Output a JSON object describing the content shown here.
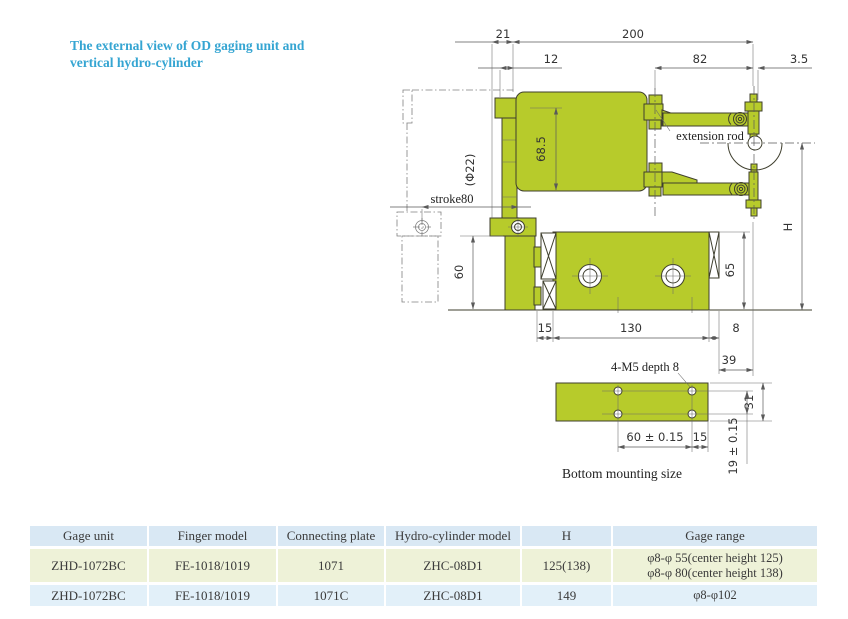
{
  "title": {
    "line1": "The external view of OD gaging unit and",
    "line2": "vertical hydro-cylinder",
    "color": "#35a5d2"
  },
  "drawing": {
    "labels": {
      "dim_21": "21",
      "dim_200": "200",
      "dim_12": "12",
      "dim_82": "82",
      "dim_3_5": "3.5",
      "dim_68_5": "68.5",
      "dim_phi22": "(Φ22)",
      "stroke80": "stroke80",
      "extension_rod": "extension rod",
      "dim_H": "H",
      "dim_60": "60",
      "dim_65": "65",
      "dim_15_front": "15",
      "dim_130": "130",
      "dim_8": "8",
      "dim_39": "39",
      "thread_note": "4-M5 depth 8",
      "dim_60_tol": "60 ± 0.15",
      "dim_15_bottom": "15",
      "dim_31": "31",
      "dim_19_tol": "19 ± 0.15",
      "bottom_caption": "Bottom mounting size"
    },
    "colors": {
      "body_green": "#b7cb2b",
      "outline": "#3f3f2e",
      "dimension_line": "#5a5a5a"
    }
  },
  "table": {
    "headers": [
      "Gage unit",
      "Finger model",
      "Connecting plate",
      "Hydro-cylinder model",
      "H",
      "Gage range"
    ],
    "rows": [
      {
        "cells": [
          "ZHD-1072BC",
          "FE-1018/1019",
          "1071",
          "ZHC-08D1",
          "125(138)"
        ],
        "range_lines": [
          "φ8-φ 55(center height 125)",
          "φ8-φ 80(center height 138)"
        ]
      },
      {
        "cells": [
          "ZHD-1072BC",
          "FE-1018/1019",
          "1071C",
          "ZHC-08D1",
          "149"
        ],
        "range_lines": [
          "φ8-φ102"
        ]
      }
    ],
    "colors": {
      "header_bg": "#d9e8f4",
      "row1_bg": "#eef2d8",
      "row2_bg": "#e2f0f9"
    }
  }
}
